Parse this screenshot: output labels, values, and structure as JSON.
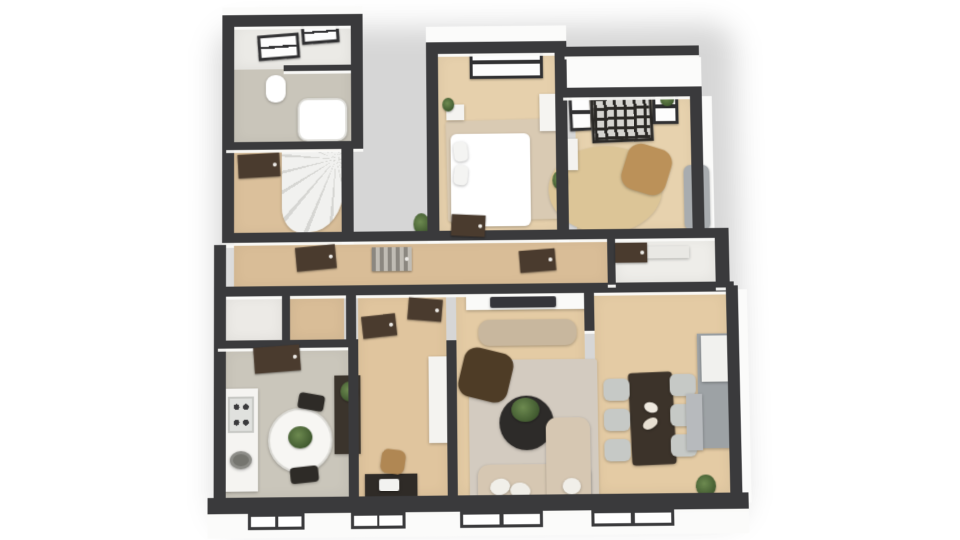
{
  "scene": {
    "width": 960,
    "height": 540,
    "background": "#ffffff",
    "view": "3d-floorplan-top-down"
  },
  "palette": {
    "wall": "#3a3a3c",
    "exterior_face": "#fbfbfa",
    "wood_hall": "#d9bd97",
    "wood_bedroom": "#e6d0ac",
    "wood_office": "#e7d2ae",
    "wood_living": "#e4cba4",
    "wood_work": "#e0c59e",
    "wood_stair": "#dbc09b",
    "floor_kitchen": "#cac6bb",
    "floor_bath": "#c9c5ba",
    "floor_bath_upper": "#ebeae6",
    "floor_closet": "#eceae6",
    "rug_beige": "#d9cab3",
    "rug_jute": "#dcc597",
    "rug_living": "#d3cbc0",
    "sofa_beige": "#d6c7b2",
    "furniture_dark": "#3b342c",
    "door_brown": "#4a3b2e",
    "chair_tan": "#bb9159",
    "chair_gray": "#c6c9c6",
    "cabinet_gray": "#9da2a5",
    "plant_green": "#55703e"
  },
  "layers": [
    {
      "id": "shadows",
      "cls": "shadow"
    },
    {
      "id": "exterior",
      "cls": "ext"
    },
    {
      "id": "rooms",
      "cls": "room"
    },
    {
      "id": "rugs",
      "cls": "rug"
    },
    {
      "id": "furniture",
      "cls": "furn"
    },
    {
      "id": "walls",
      "cls": "wall"
    },
    {
      "id": "doors",
      "cls": "door"
    },
    {
      "id": "windows",
      "cls": "window"
    }
  ],
  "shadows": [
    {
      "name": "building-shadow",
      "x": 216,
      "y": 22,
      "w": 524,
      "h": 500,
      "color": "rgba(0,0,0,0.16)"
    }
  ],
  "exterior": [
    {
      "name": "facade-top-left",
      "x": 222,
      "y": 0,
      "w": 142,
      "h": 10
    },
    {
      "name": "facade-bedroom-top",
      "x": 428,
      "y": 22,
      "w": 142,
      "h": 18
    },
    {
      "name": "facade-office-top",
      "x": 566,
      "y": 56,
      "w": 140,
      "h": 32
    },
    {
      "name": "facade-office-right",
      "x": 706,
      "y": 96,
      "w": 10,
      "h": 142
    },
    {
      "name": "facade-dining-right",
      "x": 738,
      "y": 292,
      "w": 9,
      "h": 212
    },
    {
      "name": "facade-bottom",
      "x": 208,
      "y": 510,
      "w": 536,
      "h": 24
    }
  ],
  "rooms": [
    {
      "name": "bathroom-floor",
      "x": 234,
      "y": 18,
      "w": 118,
      "h": 122,
      "color": "#c9c5ba"
    },
    {
      "name": "bathroom-upper-floor",
      "x": 234,
      "y": 18,
      "w": 118,
      "h": 46,
      "color": "#ebeae6"
    },
    {
      "name": "stair-room-floor",
      "x": 234,
      "y": 146,
      "w": 108,
      "h": 86,
      "color": "#dbc09b",
      "cls": "wood-v"
    },
    {
      "name": "bedroom-floor",
      "x": 440,
      "y": 50,
      "w": 120,
      "h": 182,
      "color": "#e6d0ac",
      "cls": "wood-v"
    },
    {
      "name": "office-floor",
      "x": 578,
      "y": 96,
      "w": 118,
      "h": 136,
      "color": "#e7d2ae",
      "cls": "wood-v"
    },
    {
      "name": "hallway-floor",
      "x": 234,
      "y": 240,
      "w": 374,
      "h": 46,
      "color": "#d9bd97",
      "cls": "wood-v"
    },
    {
      "name": "hall-closet-floor",
      "x": 616,
      "y": 240,
      "w": 100,
      "h": 44,
      "color": "#eeede9"
    },
    {
      "name": "entry-closet-floor",
      "x": 226,
      "y": 294,
      "w": 56,
      "h": 44,
      "color": "#eceae6"
    },
    {
      "name": "vestibule-floor",
      "x": 290,
      "y": 294,
      "w": 54,
      "h": 44,
      "color": "#d9bd97",
      "cls": "wood-v"
    },
    {
      "name": "kitchen-floor",
      "x": 226,
      "y": 346,
      "w": 122,
      "h": 148,
      "color": "#cac6bb"
    },
    {
      "name": "workroom-floor",
      "x": 358,
      "y": 294,
      "w": 88,
      "h": 200,
      "color": "#e0c59e",
      "cls": "wood-h"
    },
    {
      "name": "living-room-floor",
      "x": 456,
      "y": 294,
      "w": 128,
      "h": 200,
      "color": "#e4cba4",
      "cls": "wood-h"
    },
    {
      "name": "dining-room-floor",
      "x": 594,
      "y": 294,
      "w": 132,
      "h": 200,
      "color": "#e4cba4",
      "cls": "wood-h"
    }
  ],
  "rugs": [
    {
      "name": "bedroom-rug",
      "x": 448,
      "y": 118,
      "w": 114,
      "h": 102,
      "color": "#d9cab3",
      "rot": -1
    },
    {
      "name": "office-jute-rug",
      "x": 550,
      "y": 146,
      "w": 114,
      "h": 88,
      "color": "#dcc597",
      "shape": "ellipse"
    },
    {
      "name": "living-room-rug",
      "x": 468,
      "y": 360,
      "w": 128,
      "h": 144,
      "color": "#d3cbc0"
    }
  ],
  "furniture": [
    {
      "name": "bathroom-roof-window-1",
      "x": 258,
      "y": 28,
      "w": 42,
      "h": 26,
      "cls": "win-grid",
      "rot": -4
    },
    {
      "name": "bathroom-roof-window-2",
      "x": 302,
      "y": 14,
      "w": 38,
      "h": 24,
      "cls": "win-grid",
      "rot": -4
    },
    {
      "name": "toilet",
      "x": 266,
      "y": 70,
      "w": 20,
      "h": 28,
      "color": "#ffffff",
      "r": 9
    },
    {
      "name": "bathtub",
      "x": 298,
      "y": 94,
      "w": 50,
      "h": 44,
      "color": "#ffffff",
      "r": 10,
      "border": "2px solid #dddcd7"
    },
    {
      "name": "spiral-staircase",
      "x": 282,
      "y": 148,
      "w": 62,
      "h": 82,
      "cls": "stair"
    },
    {
      "name": "bedroom-window",
      "x": 472,
      "y": 42,
      "w": 74,
      "h": 34,
      "cls": "win-grid"
    },
    {
      "name": "bed",
      "x": 452,
      "y": 132,
      "w": 80,
      "h": 94,
      "color": "#ffffff",
      "r": 6
    },
    {
      "name": "bed-pillow-top",
      "x": 455,
      "y": 140,
      "w": 14,
      "h": 20,
      "color": "#f4f4f2",
      "r": 5,
      "rot": -6
    },
    {
      "name": "bed-pillow-bottom",
      "x": 455,
      "y": 164,
      "w": 14,
      "h": 20,
      "color": "#f4f4f2",
      "r": 5,
      "rot": 5
    },
    {
      "name": "nightstand",
      "x": 448,
      "y": 102,
      "w": 18,
      "h": 16,
      "color": "#f4f3f0"
    },
    {
      "name": "bedroom-plant",
      "x": 444,
      "y": 95,
      "w": 12,
      "h": 14,
      "cls": "plant"
    },
    {
      "name": "bedroom-wardrobe",
      "x": 542,
      "y": 92,
      "w": 20,
      "h": 38,
      "color": "#f5f4f1"
    },
    {
      "name": "office-window-left",
      "x": 572,
      "y": 92,
      "w": 24,
      "h": 38,
      "cls": "win-grid",
      "rot": -2
    },
    {
      "name": "office-cube-shelf",
      "x": 594,
      "y": 94,
      "w": 62,
      "h": 48,
      "cls": "shelf-grid",
      "rot": -2
    },
    {
      "name": "office-window-right",
      "x": 656,
      "y": 88,
      "w": 26,
      "h": 36,
      "cls": "win-grid"
    },
    {
      "name": "office-window-plant",
      "x": 664,
      "y": 92,
      "w": 14,
      "h": 14,
      "cls": "plant"
    },
    {
      "name": "office-armchair",
      "x": 626,
      "y": 146,
      "w": 46,
      "h": 48,
      "color": "#bb9159",
      "r": 14,
      "rot": 18
    },
    {
      "name": "office-sofa",
      "x": 686,
      "y": 166,
      "w": 26,
      "h": 66,
      "color": "#a8acaf",
      "r": 7
    },
    {
      "name": "office-floor-plant",
      "x": 554,
      "y": 170,
      "w": 16,
      "h": 20,
      "cls": "plant"
    },
    {
      "name": "office-cabinet",
      "x": 566,
      "y": 138,
      "w": 14,
      "h": 32,
      "color": "#f3f2ef"
    },
    {
      "name": "hallway-plant",
      "x": 414,
      "y": 212,
      "w": 16,
      "h": 22,
      "cls": "plant"
    },
    {
      "name": "kitchen-counter",
      "x": 224,
      "y": 386,
      "w": 34,
      "h": 102,
      "color": "#f5f4f1"
    },
    {
      "name": "kitchen-cooktop",
      "x": 228,
      "y": 394,
      "w": 26,
      "h": 36,
      "cls": "cooktop"
    },
    {
      "name": "kitchen-sink",
      "x": 230,
      "y": 448,
      "w": 22,
      "h": 18,
      "color": "#75756f",
      "shape": "ellipse",
      "border": "3px solid #8d8d88"
    },
    {
      "name": "kitchen-round-table",
      "x": 268,
      "y": 406,
      "w": 64,
      "h": 64,
      "color": "#f7f6f3",
      "shape": "ellipse",
      "border": "2px solid #dcdbd6"
    },
    {
      "name": "kitchen-table-plant",
      "x": 288,
      "y": 424,
      "w": 24,
      "h": 22,
      "cls": "plant"
    },
    {
      "name": "kitchen-chair-north",
      "x": 298,
      "y": 392,
      "w": 26,
      "h": 16,
      "color": "#2e2b27",
      "r": 4,
      "rot": 10
    },
    {
      "name": "kitchen-chair-south",
      "x": 290,
      "y": 464,
      "w": 28,
      "h": 16,
      "color": "#2e2b27",
      "r": 4,
      "rot": -6
    },
    {
      "name": "workroom-sideboard",
      "x": 334,
      "y": 374,
      "w": 26,
      "h": 78,
      "color": "#3b342c"
    },
    {
      "name": "workroom-sideboard-plant",
      "x": 340,
      "y": 380,
      "w": 18,
      "h": 20,
      "cls": "plant"
    },
    {
      "name": "desk",
      "x": 364,
      "y": 472,
      "w": 52,
      "h": 24,
      "color": "#2f2b27"
    },
    {
      "name": "desk-laptop",
      "x": 378,
      "y": 477,
      "w": 20,
      "h": 12,
      "color": "#f2f2f0",
      "r": 2
    },
    {
      "name": "desk-chair",
      "x": 380,
      "y": 448,
      "w": 24,
      "h": 24,
      "color": "#b08753",
      "r": 7,
      "rot": 8
    },
    {
      "name": "workroom-white-dresser",
      "x": 428,
      "y": 356,
      "w": 26,
      "h": 86,
      "color": "#f4f3f0"
    },
    {
      "name": "tv-wall-panel",
      "x": 466,
      "y": 294,
      "w": 122,
      "h": 16,
      "color": "#fafaf8"
    },
    {
      "name": "tv-screen",
      "x": 490,
      "y": 297,
      "w": 66,
      "h": 11,
      "color": "#35353a",
      "r": 2
    },
    {
      "name": "media-console",
      "x": 478,
      "y": 320,
      "w": 98,
      "h": 26,
      "color": "#c8b79e",
      "r": 11
    },
    {
      "name": "living-lounge-chair",
      "x": 460,
      "y": 350,
      "w": 50,
      "h": 50,
      "color": "#4e3c26",
      "r": 13,
      "rot": 14
    },
    {
      "name": "coffee-table",
      "x": 498,
      "y": 396,
      "w": 54,
      "h": 54,
      "color": "#2d2b29",
      "shape": "ellipse"
    },
    {
      "name": "coffee-table-plant",
      "x": 510,
      "y": 398,
      "w": 28,
      "h": 24,
      "cls": "plant"
    },
    {
      "name": "sofa-seat",
      "x": 476,
      "y": 464,
      "w": 112,
      "h": 40,
      "color": "#d6c7b2",
      "r": 11
    },
    {
      "name": "sofa-chaise",
      "x": 544,
      "y": 418,
      "w": 44,
      "h": 86,
      "color": "#d6c7b2",
      "r": 11
    },
    {
      "name": "sofa-pillow-1",
      "x": 488,
      "y": 478,
      "w": 20,
      "h": 16,
      "color": "#f1efe9",
      "shape": "ellipse",
      "rot": -15
    },
    {
      "name": "sofa-pillow-2",
      "x": 508,
      "y": 482,
      "w": 20,
      "h": 16,
      "color": "#efede7",
      "shape": "ellipse",
      "rot": 10
    },
    {
      "name": "sofa-pillow-3",
      "x": 560,
      "y": 478,
      "w": 18,
      "h": 16,
      "color": "#f1efe9",
      "shape": "ellipse"
    },
    {
      "name": "dining-table",
      "x": 628,
      "y": 374,
      "w": 44,
      "h": 92,
      "color": "#3c332a",
      "r": 4,
      "rot": -2
    },
    {
      "name": "dining-decor-bowl-1",
      "x": 642,
      "y": 404,
      "w": 14,
      "h": 10,
      "color": "#efe9df",
      "shape": "ellipse",
      "rot": 20
    },
    {
      "name": "dining-decor-bowl-2",
      "x": 640,
      "y": 420,
      "w": 16,
      "h": 10,
      "color": "#e8e0d2",
      "shape": "ellipse",
      "rot": -30
    },
    {
      "name": "dining-chair-left-1",
      "x": 602,
      "y": 380,
      "w": 26,
      "h": 22,
      "color": "#c6c9c6",
      "r": 6
    },
    {
      "name": "dining-chair-left-2",
      "x": 602,
      "y": 410,
      "w": 26,
      "h": 22,
      "color": "#c6c9c6",
      "r": 6
    },
    {
      "name": "dining-chair-left-3",
      "x": 602,
      "y": 440,
      "w": 26,
      "h": 22,
      "color": "#c6c9c6",
      "r": 6
    },
    {
      "name": "dining-chair-right-1",
      "x": 668,
      "y": 376,
      "w": 26,
      "h": 22,
      "color": "#c6c9c6",
      "r": 6
    },
    {
      "name": "dining-chair-right-2",
      "x": 668,
      "y": 406,
      "w": 26,
      "h": 22,
      "color": "#c6c9c6",
      "r": 6
    },
    {
      "name": "dining-chair-right-3",
      "x": 668,
      "y": 436,
      "w": 26,
      "h": 22,
      "color": "#c6c9c6",
      "r": 6
    },
    {
      "name": "dining-gray-sideboard",
      "x": 696,
      "y": 336,
      "w": 36,
      "h": 114,
      "color": "#9da2a5"
    },
    {
      "name": "dining-sideboard-top",
      "x": 700,
      "y": 338,
      "w": 32,
      "h": 46,
      "color": "#f1f1ee"
    },
    {
      "name": "dining-marble-cabinet",
      "x": 684,
      "y": 396,
      "w": 16,
      "h": 56,
      "color": "#b7babd"
    },
    {
      "name": "dining-corner-plant",
      "x": 692,
      "y": 476,
      "w": 20,
      "h": 22,
      "cls": "plant"
    },
    {
      "name": "hall-closet-shelf",
      "x": 640,
      "y": 248,
      "w": 50,
      "h": 12,
      "color": "#e9e8e4"
    }
  ],
  "walls": [
    {
      "name": "wall-topwing-north",
      "x": 222,
      "y": 8,
      "w": 142,
      "h": 12
    },
    {
      "name": "wall-west-upper",
      "x": 222,
      "y": 8,
      "w": 12,
      "h": 234
    },
    {
      "name": "wall-bathroom-east",
      "x": 352,
      "y": 8,
      "w": 12,
      "h": 138
    },
    {
      "name": "wall-bath-stair-divider",
      "x": 226,
      "y": 138,
      "w": 126,
      "h": 8
    },
    {
      "name": "wall-bath-partition",
      "x": 284,
      "y": 60,
      "w": 68,
      "h": 6
    },
    {
      "name": "wall-stair-east",
      "x": 342,
      "y": 146,
      "w": 12,
      "h": 94
    },
    {
      "name": "wall-bedroom-north",
      "x": 428,
      "y": 38,
      "w": 142,
      "h": 12
    },
    {
      "name": "wall-bedroom-west",
      "x": 428,
      "y": 38,
      "w": 12,
      "h": 202
    },
    {
      "name": "wall-bedroom-office-divider",
      "x": 558,
      "y": 38,
      "w": 12,
      "h": 202
    },
    {
      "name": "wall-office-parapet",
      "x": 568,
      "y": 44,
      "w": 136,
      "h": 10
    },
    {
      "name": "wall-office-north",
      "x": 566,
      "y": 86,
      "w": 140,
      "h": 10
    },
    {
      "name": "wall-office-east",
      "x": 694,
      "y": 86,
      "w": 12,
      "h": 154
    },
    {
      "name": "wall-hallway-north",
      "x": 222,
      "y": 230,
      "w": 494,
      "h": 10
    },
    {
      "name": "wall-hallway-south",
      "x": 222,
      "y": 284,
      "w": 512,
      "h": 10
    },
    {
      "name": "wall-closet-west",
      "x": 608,
      "y": 240,
      "w": 8,
      "h": 46
    },
    {
      "name": "wall-closet-east",
      "x": 716,
      "y": 230,
      "w": 14,
      "h": 60
    },
    {
      "name": "wall-west-lower",
      "x": 214,
      "y": 242,
      "w": 12,
      "h": 266
    },
    {
      "name": "wall-entry-divider-1",
      "x": 282,
      "y": 292,
      "w": 8,
      "h": 48
    },
    {
      "name": "wall-entry-divider-2",
      "x": 346,
      "y": 292,
      "w": 10,
      "h": 48
    },
    {
      "name": "wall-kitchen-north",
      "x": 218,
      "y": 338,
      "w": 136,
      "h": 8
    },
    {
      "name": "wall-kitchen-east",
      "x": 348,
      "y": 338,
      "w": 10,
      "h": 160
    },
    {
      "name": "wall-work-living-divider",
      "x": 446,
      "y": 340,
      "w": 10,
      "h": 158
    },
    {
      "name": "wall-living-dining-stub",
      "x": 584,
      "y": 288,
      "w": 10,
      "h": 44
    },
    {
      "name": "wall-dining-east",
      "x": 726,
      "y": 288,
      "w": 12,
      "h": 210
    },
    {
      "name": "wall-south",
      "x": 208,
      "y": 494,
      "w": 536,
      "h": 16
    }
  ],
  "doors": [
    {
      "name": "stair-room-door",
      "x": 238,
      "y": 150,
      "w": 42,
      "h": 24,
      "rot": -3
    },
    {
      "name": "hallway-door-1",
      "x": 296,
      "y": 244,
      "w": 40,
      "h": 24,
      "rot": -5
    },
    {
      "name": "hallway-glass-door",
      "x": 372,
      "y": 246,
      "w": 40,
      "h": 24,
      "cls": "door-glass"
    },
    {
      "name": "bedroom-door",
      "x": 452,
      "y": 214,
      "w": 34,
      "h": 22,
      "rot": 3
    },
    {
      "name": "hallway-door-2",
      "x": 520,
      "y": 250,
      "w": 36,
      "h": 22,
      "rot": -4
    },
    {
      "name": "hall-closet-door",
      "x": 616,
      "y": 244,
      "w": 32,
      "h": 20
    },
    {
      "name": "workroom-door-west",
      "x": 362,
      "y": 314,
      "w": 34,
      "h": 22,
      "rot": -6
    },
    {
      "name": "workroom-door-east",
      "x": 408,
      "y": 298,
      "w": 34,
      "h": 22,
      "rot": 5
    },
    {
      "name": "kitchen-door",
      "x": 254,
      "y": 344,
      "w": 46,
      "h": 26,
      "rot": -4
    }
  ],
  "windows": [
    {
      "name": "facade-window-kitchen",
      "x": 248,
      "y": 510,
      "w": 56,
      "h": 16
    },
    {
      "name": "facade-window-workroom",
      "x": 350,
      "y": 510,
      "w": 54,
      "h": 16
    },
    {
      "name": "facade-window-living",
      "x": 458,
      "y": 510,
      "w": 82,
      "h": 16
    },
    {
      "name": "facade-window-dining",
      "x": 588,
      "y": 510,
      "w": 82,
      "h": 16
    }
  ]
}
